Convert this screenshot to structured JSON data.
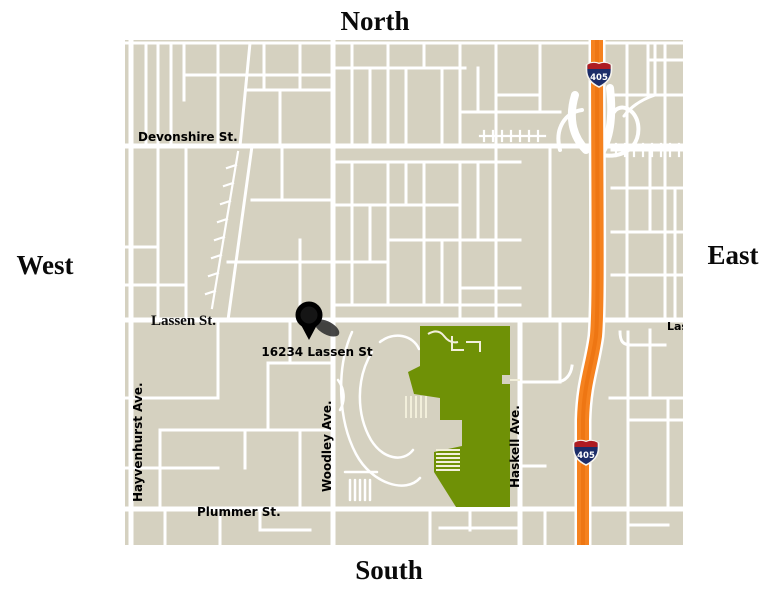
{
  "compass": {
    "north": "North",
    "south": "South",
    "west": "West",
    "east": "East"
  },
  "map": {
    "labels": {
      "devonshire": "Devonshire St.",
      "lassen": "Lassen St.",
      "lassen_truncated": "Las",
      "plummer": "Plummer St.",
      "hayvenhurst": "Hayvenhurst Ave.",
      "woodley": "Woodley Ave.",
      "haskell": "Haskell Ave."
    },
    "marker": {
      "address": "16234 Lassen St"
    },
    "shields": [
      {
        "label": "405"
      },
      {
        "label": "405"
      }
    ],
    "colors": {
      "map_background": "#d5d1c0",
      "road": "#ffffff",
      "freeway_orange": "#f5821f",
      "freeway_core": "#ea700e",
      "park_green": "#6f9106",
      "park_path": "#f2efdb",
      "shield_blue": "#1c2d69",
      "shield_red": "#ae1c22",
      "label_text": "#000000",
      "marker_black": "#0d0d0d",
      "marker_shadow": "#2e2e2e"
    }
  }
}
